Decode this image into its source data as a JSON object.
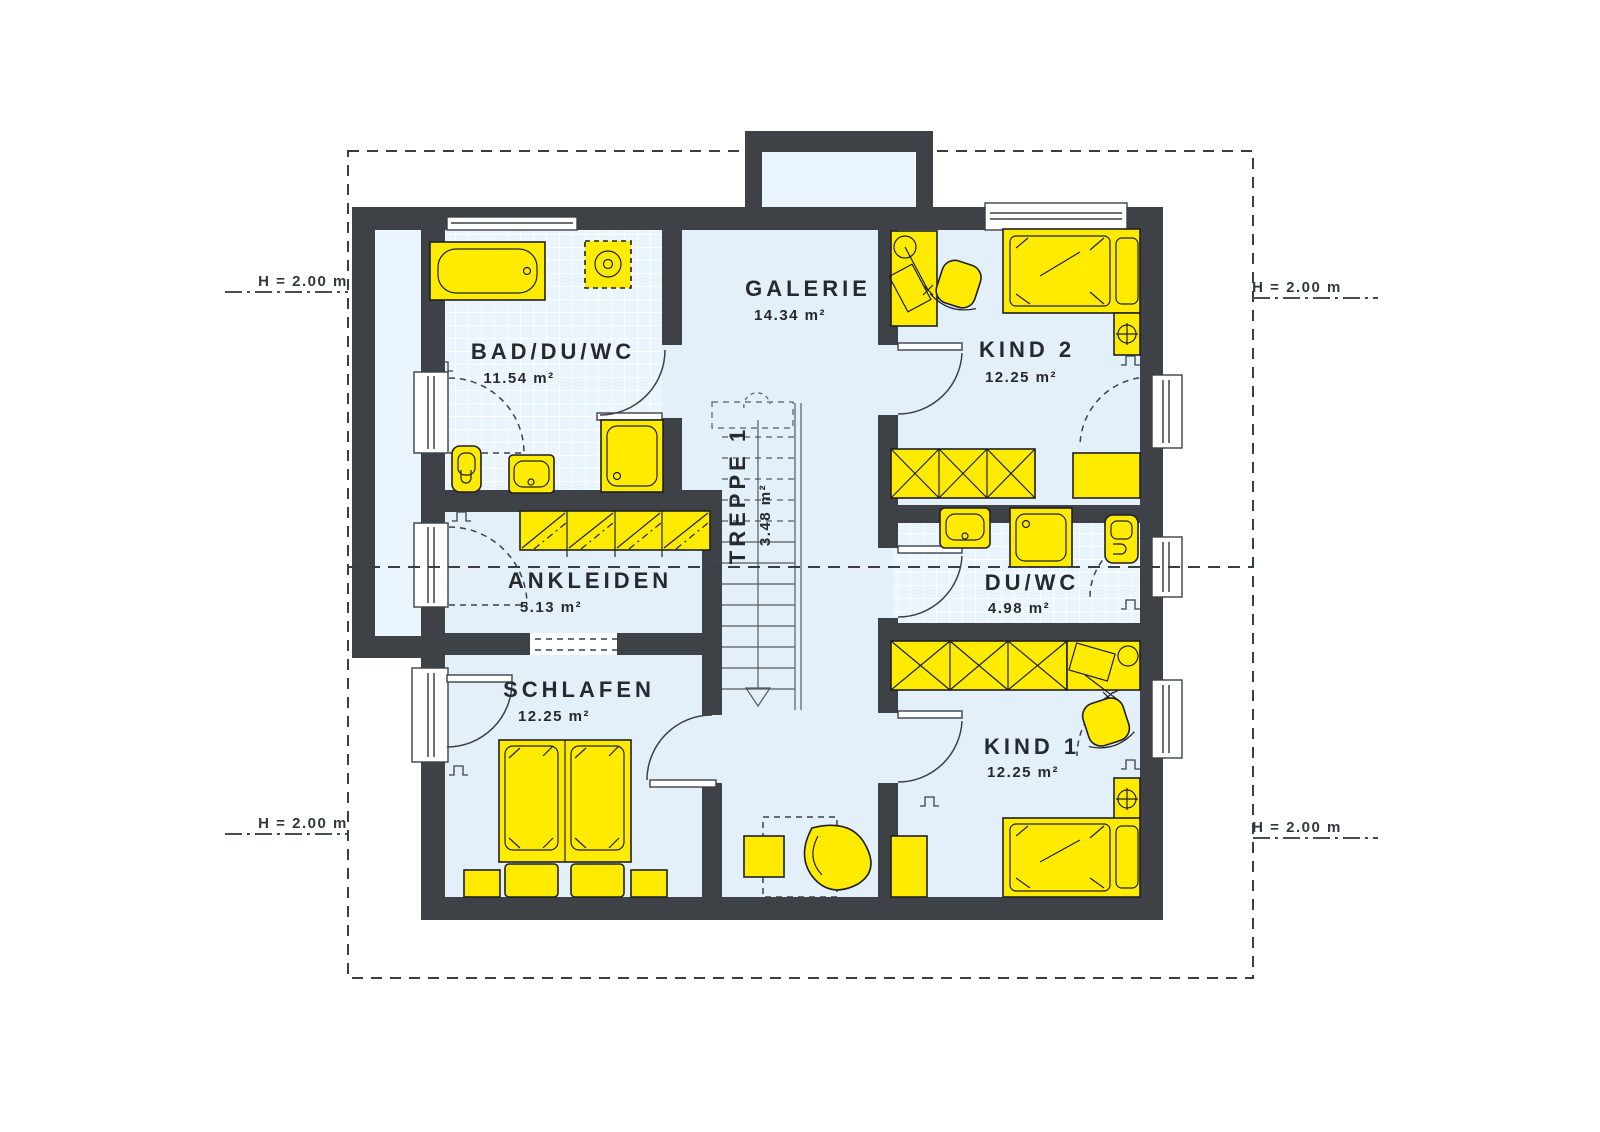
{
  "colors": {
    "wall": "#3e4247",
    "floor": "#e3f0fa",
    "floor_light": "#eaf5fd",
    "furniture_yellow": "#ffeb00",
    "text": "#26292e"
  },
  "rooms": [
    {
      "id": "bad",
      "name": "BAD/DU/WC",
      "area": "11.54 m²"
    },
    {
      "id": "galerie",
      "name": "GALERIE",
      "area": "14.34 m²"
    },
    {
      "id": "kind2",
      "name": "KIND 2",
      "area": "12.25 m²"
    },
    {
      "id": "treppe",
      "name": "TREPPE 1",
      "area": "3.48 m²"
    },
    {
      "id": "ankleiden",
      "name": "ANKLEIDEN",
      "area": "5.13 m²"
    },
    {
      "id": "duwc",
      "name": "DU/WC",
      "area": "4.98 m²"
    },
    {
      "id": "schlafen",
      "name": "SCHLAFEN",
      "area": "12.25 m²"
    },
    {
      "id": "kind1",
      "name": "KIND 1",
      "area": "12.25 m²"
    }
  ],
  "section": {
    "label": "H = 2.00 m"
  }
}
